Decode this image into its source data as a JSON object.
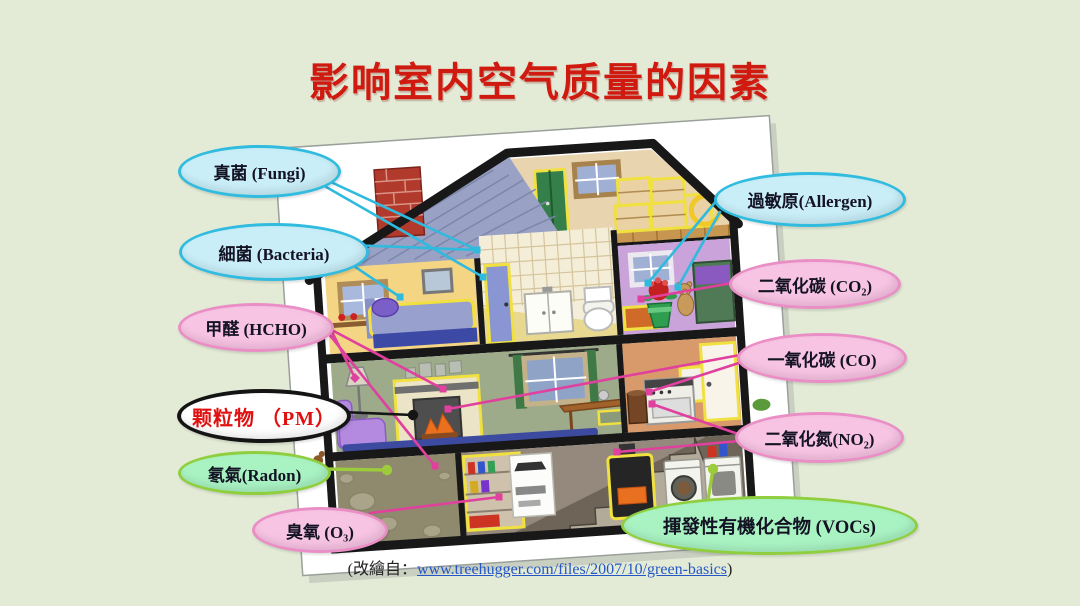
{
  "slide": {
    "title": "影响室内空气质量的因素",
    "background_color": "#e3ebd7",
    "title_color": "#d01a10",
    "paper_color": "#ffffff"
  },
  "citation": {
    "prefix": "(改繪自：",
    "link": "www.treehugger.com/files/2007/10/green-basics",
    "suffix": ")"
  },
  "legend_colors": {
    "biological_line": "#2fbade",
    "chemical_line": "#e0409e",
    "ground_line": "#9ccb3b",
    "pm_line": "#151515"
  },
  "bubbles": [
    {
      "id": "fungi",
      "label": "真菌 (Fungi)",
      "fill": "#c9eef8",
      "border": "#31bcdf",
      "text_color": "#131324"
    },
    {
      "id": "bacteria",
      "label": "細菌 (Bacteria)",
      "fill": "#c9eef8",
      "border": "#31bcdf",
      "text_color": "#131324"
    },
    {
      "id": "hcho",
      "label": "甲醛 (HCHO)",
      "fill": "#f8c4e4",
      "border": "#ea8fc6",
      "text_color": "#131324"
    },
    {
      "id": "pm",
      "label": "颗粒物 （PM）",
      "fill": "#ffffff",
      "border": "#141414",
      "text_color": "#e01010"
    },
    {
      "id": "radon",
      "label": "氡氣(Radon)",
      "fill": "#a9f3c3",
      "border": "#8fcf3f",
      "text_color": "#131324"
    },
    {
      "id": "ozone",
      "label": "臭氧 (O₃)",
      "fill": "#f8c4e4",
      "border": "#ea8fc6",
      "text_color": "#131324"
    },
    {
      "id": "allergen",
      "label": "過敏原(Allergen)",
      "fill": "#c9eef8",
      "border": "#31bcdf",
      "text_color": "#131324"
    },
    {
      "id": "co2",
      "label": "二氧化碳 (CO₂)",
      "fill": "#f8c4e4",
      "border": "#ea8fc6",
      "text_color": "#131324"
    },
    {
      "id": "co",
      "label": "一氧化碳 (CO)",
      "fill": "#f8c4e4",
      "border": "#ea8fc6",
      "text_color": "#131324"
    },
    {
      "id": "no2",
      "label": "二氧化氮(NO₂)",
      "fill": "#f8c4e4",
      "border": "#ea8fc6",
      "text_color": "#131324"
    },
    {
      "id": "vocs",
      "label": "揮發性有機化合物 (VOCs)",
      "fill": "#a9f3c3",
      "border": "#8fcf3f",
      "text_color": "#131324"
    }
  ],
  "connectors": [
    {
      "from": "fungi",
      "to": "bathroom-wall",
      "color": "#2fbade",
      "width": 2.6,
      "x1": 318,
      "y1": 176,
      "x2": 477,
      "y2": 250,
      "marker": "square"
    },
    {
      "from": "fungi",
      "to": "bathroom-door",
      "color": "#2fbade",
      "width": 2.6,
      "x1": 321,
      "y1": 184,
      "x2": 483,
      "y2": 277,
      "marker": "square"
    },
    {
      "from": "bacteria",
      "to": "bed",
      "color": "#2fbade",
      "width": 2.6,
      "x1": 345,
      "y1": 260,
      "x2": 400,
      "y2": 297,
      "marker": "square"
    },
    {
      "from": "bacteria",
      "to": "bathroom-wall",
      "color": "#2fbade",
      "width": 2.6,
      "x1": 350,
      "y1": 245,
      "x2": 477,
      "y2": 250,
      "marker": "square"
    },
    {
      "from": "allergen",
      "to": "plant",
      "color": "#2fbade",
      "width": 2.6,
      "x1": 717,
      "y1": 200,
      "x2": 648,
      "y2": 283,
      "marker": "square"
    },
    {
      "from": "allergen",
      "to": "teddy-bear",
      "color": "#2fbade",
      "width": 2.6,
      "x1": 720,
      "y1": 212,
      "x2": 678,
      "y2": 287,
      "marker": "square"
    },
    {
      "from": "hcho",
      "to": "lamp",
      "color": "#e0409e",
      "width": 2.6,
      "x1": 326,
      "y1": 320,
      "x2": 355,
      "y2": 378,
      "marker": "diamond"
    },
    {
      "from": "hcho",
      "to": "fireplace-mantel",
      "color": "#e0409e",
      "width": 2.6,
      "x1": 328,
      "y1": 328,
      "x2": 443,
      "y2": 389,
      "marker": "square"
    },
    {
      "from": "hcho",
      "to": "basement-shelf",
      "color": "#e0409e",
      "width": 2.6,
      "x1": 329,
      "y1": 334,
      "x2": 435,
      "y2": 466,
      "marker": "square"
    },
    {
      "from": "co2",
      "to": "person-plant",
      "color": "#e0409e",
      "width": 2.6,
      "x1": 732,
      "y1": 283,
      "x2": 641,
      "y2": 299,
      "marker": "square"
    },
    {
      "from": "co",
      "to": "fireplace-fire",
      "color": "#e0409e",
      "width": 2.6,
      "x1": 740,
      "y1": 355,
      "x2": 448,
      "y2": 409,
      "marker": "square"
    },
    {
      "from": "co",
      "to": "stove",
      "color": "#e0409e",
      "width": 2.6,
      "x1": 742,
      "y1": 362,
      "x2": 649,
      "y2": 392,
      "marker": "square"
    },
    {
      "from": "no2",
      "to": "stove",
      "color": "#e0409e",
      "width": 2.6,
      "x1": 738,
      "y1": 434,
      "x2": 652,
      "y2": 404,
      "marker": "square"
    },
    {
      "from": "no2",
      "to": "furnace",
      "color": "#e0409e",
      "width": 2.6,
      "x1": 739,
      "y1": 441,
      "x2": 617,
      "y2": 452,
      "marker": "square"
    },
    {
      "from": "ozone",
      "to": "photocopier",
      "color": "#e0409e",
      "width": 2.6,
      "x1": 370,
      "y1": 513,
      "x2": 499,
      "y2": 497,
      "marker": "square"
    },
    {
      "from": "radon",
      "to": "soil",
      "color": "#9ccb3b",
      "width": 3.4,
      "x1": 323,
      "y1": 469,
      "x2": 387,
      "y2": 470,
      "marker": "dot"
    },
    {
      "from": "vocs",
      "to": "dryer",
      "color": "#9ccb3b",
      "width": 3.4,
      "x1": 708,
      "y1": 500,
      "x2": 713,
      "y2": 469,
      "marker": "dot"
    },
    {
      "from": "pm",
      "to": "fireplace",
      "color": "#151515",
      "width": 2.6,
      "x1": 341,
      "y1": 412,
      "x2": 413,
      "y2": 415,
      "marker": "dot"
    }
  ]
}
